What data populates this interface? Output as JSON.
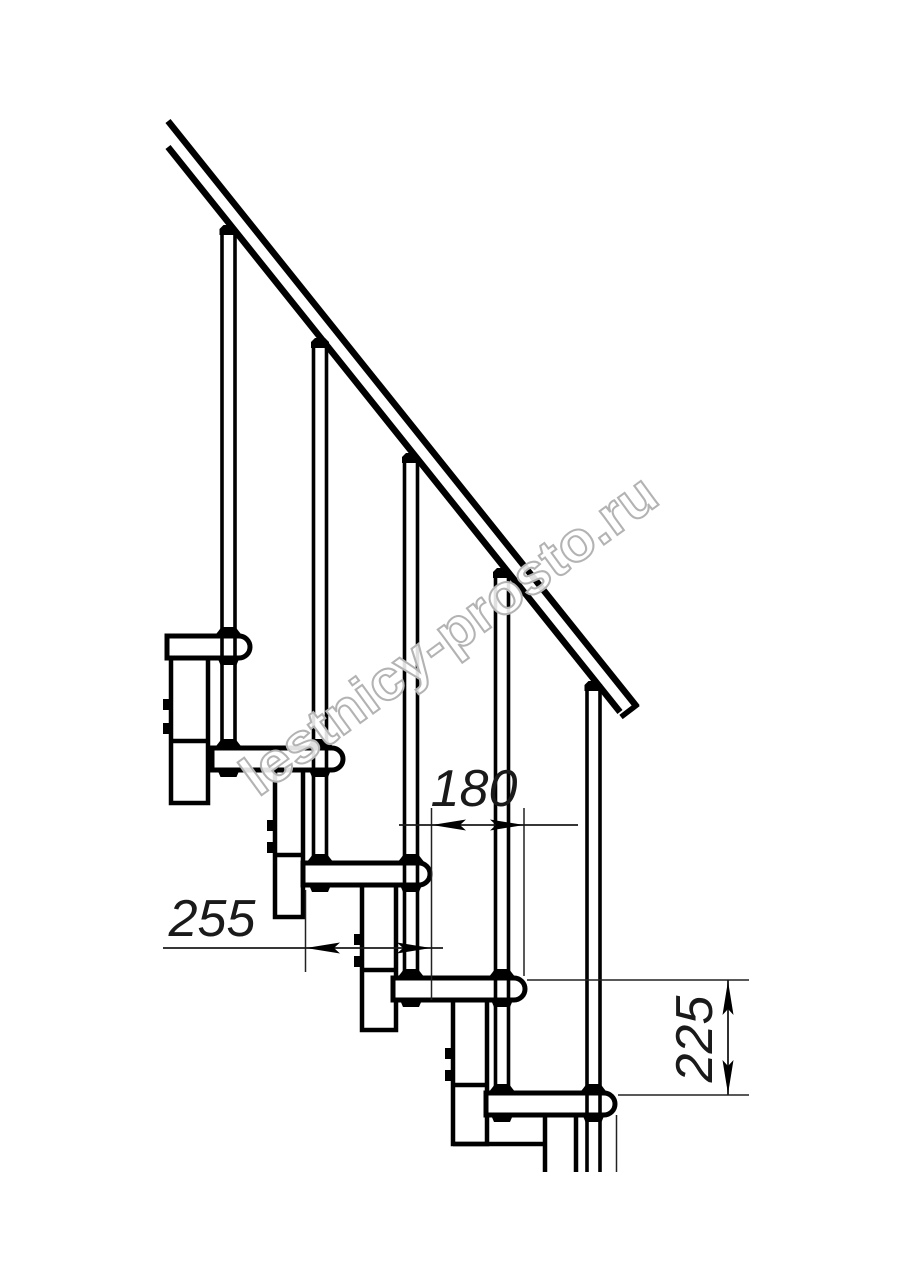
{
  "title": "staircase-side-elevation-drawing",
  "colors": {
    "background": "#ffffff",
    "line": "#000000",
    "dimension_line": "#1a1a1a",
    "watermark_outline": "#b3b3b3"
  },
  "watermark": {
    "text": "lestnicy-prosto.ru"
  },
  "dimensions": {
    "tread_depth": {
      "value": "255"
    },
    "step_run": {
      "value": "180"
    },
    "step_height": {
      "value": "225"
    }
  },
  "drawing": {
    "treads_visible": 5,
    "balusters_visible": 5,
    "support_columns_visible": 5
  }
}
